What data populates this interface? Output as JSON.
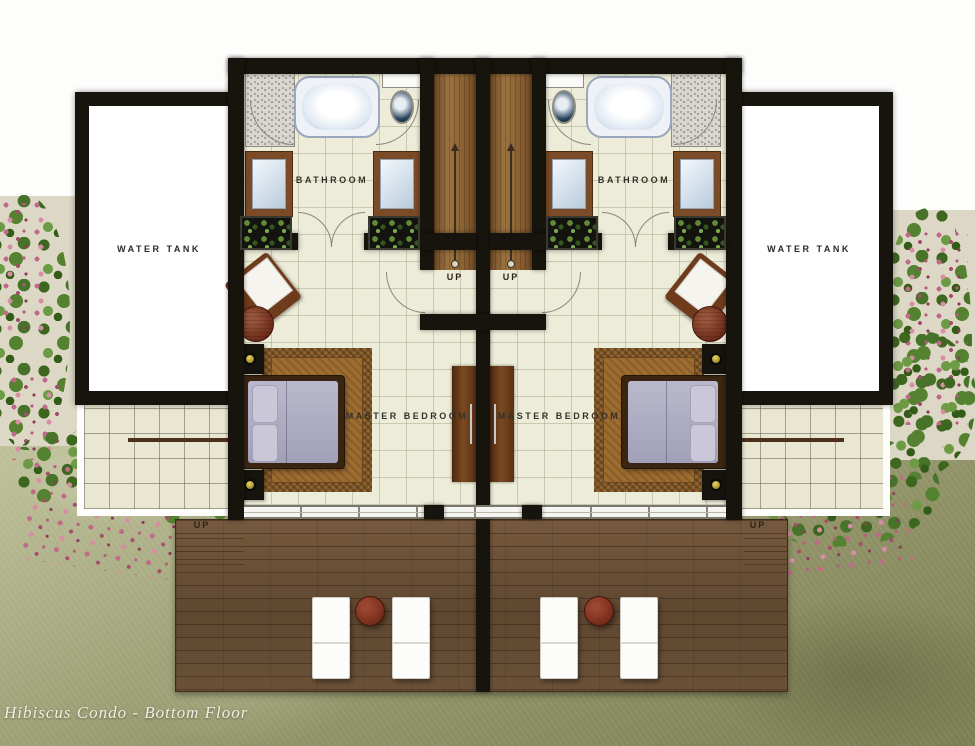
{
  "caption": "Hibiscus Condo - Bottom Floor",
  "units": {
    "left": {
      "bathroom": "BATHROOM",
      "bedroom": "MASTER BEDROOM",
      "water_tank": "WATER TANK",
      "stair_up": "UP",
      "deck_up": "UP"
    },
    "right": {
      "bathroom": "BATHROOM",
      "bedroom": "MASTER BEDROOM",
      "water_tank": "WATER TANK",
      "stair_up": "UP",
      "deck_up": "UP"
    }
  },
  "colors": {
    "wall": "#17130d",
    "floor": "#edecd8",
    "deck_wood": "#6d5339",
    "stair_wood": "#8d6536",
    "grass_light": "#c1c49d",
    "grass_dark": "#7b7d52",
    "sand": "#dcd8c5",
    "rug": "#9c6c31",
    "bed_linen": "#b0aec4",
    "foliage": "#47722a",
    "flowers": "#c2688a",
    "tub_rim": "#9aa8bd",
    "table_wood": "#6e2c1a"
  }
}
